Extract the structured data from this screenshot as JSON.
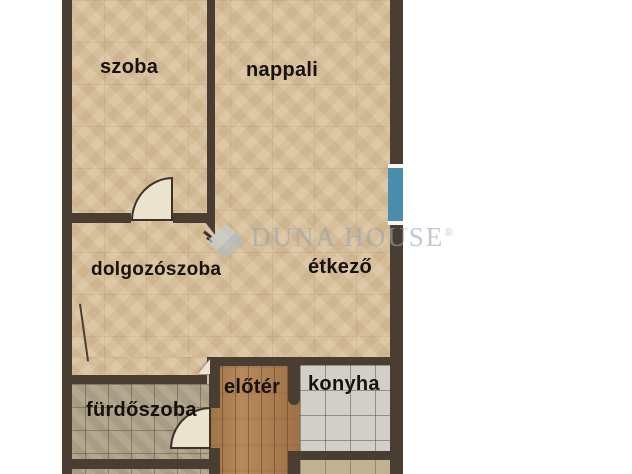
{
  "rooms": [
    {
      "id": "szoba",
      "label": "szoba"
    },
    {
      "id": "nappali",
      "label": "nappali"
    },
    {
      "id": "dolgozoszoba",
      "label": "dolgozószoba"
    },
    {
      "id": "etkezo",
      "label": "étkező"
    },
    {
      "id": "eloter",
      "label": "előtér"
    },
    {
      "id": "konyha",
      "label": "konyha"
    },
    {
      "id": "furdoszoba",
      "label": "fürdőszoba"
    }
  ],
  "watermark": {
    "brand": "DUNA HOUSE",
    "registered": "®"
  },
  "colors": {
    "wall": "#4a3e33",
    "floor_beige": "#d8c09a",
    "floor_bath": "#b0a289",
    "floor_kitchen": "#d2cfc9",
    "floor_pantry": "#c0b193",
    "floor_wood": "#b07f4e",
    "door_leaf": "#ece3cf",
    "window_blue": "#4b8dac",
    "watermark": "#98a4b0"
  }
}
